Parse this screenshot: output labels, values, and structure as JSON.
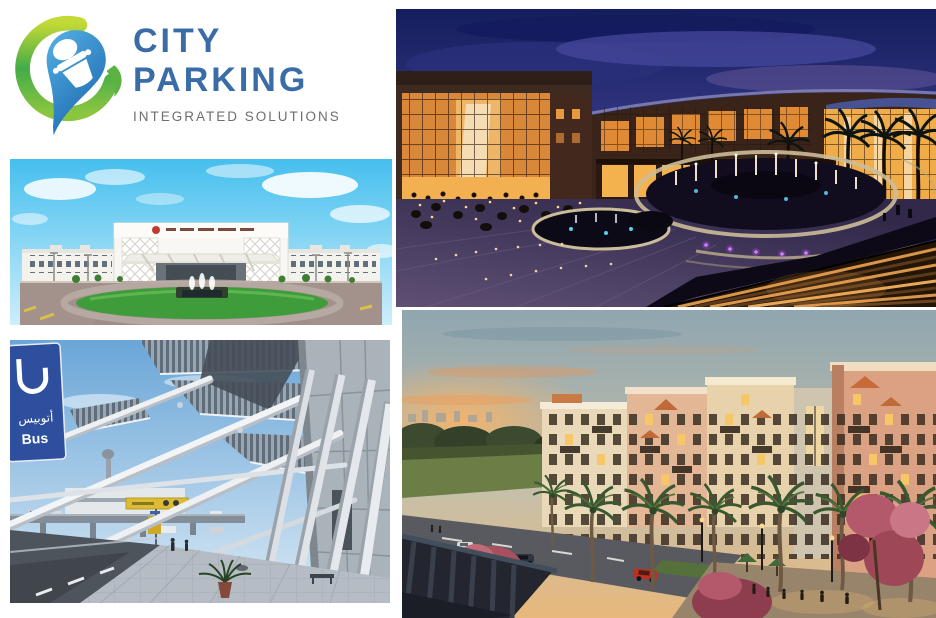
{
  "page": {
    "background": "#ffffff"
  },
  "logo": {
    "name_line1": "CITY",
    "name_line2": "PARKING",
    "tagline": "INTEGRATED SOLUTIONS",
    "name_color": "#3a6da8",
    "tagline_color": "#6d6e71",
    "swoosh_yellow_green": "#c3d935",
    "swoosh_green": "#2f9e4e",
    "pin_blue_light": "#55b0e4",
    "pin_blue_dark": "#1a66ad",
    "icon": "car-location-pin-icon"
  },
  "photos": {
    "mall": {
      "alt": "Shopping mall courtyard with illuminated fountain plaza at dusk"
    },
    "hospital": {
      "alt": "White hospital building with entrance canopy, roundabout lawn and fountain under blue sky"
    },
    "airport": {
      "alt": "Airport terminal curbside with white canopy structure, blue bus sign and tiled walkway"
    },
    "residential": {
      "alt": "Mediterranean-style apartment buildings with palm trees and street at sunset"
    },
    "airport_bus_sign": {
      "arabic": "أتوبيس",
      "english": "Bus"
    }
  }
}
